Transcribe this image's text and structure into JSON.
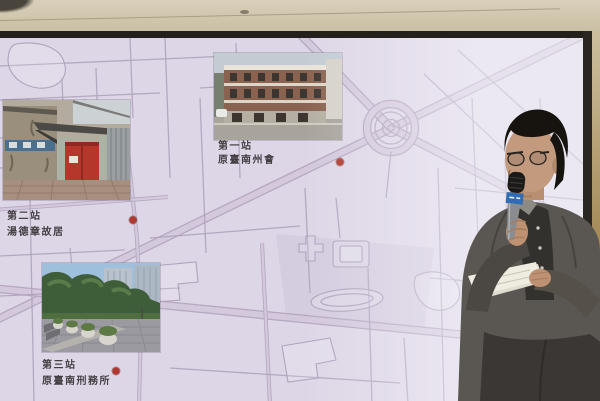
{
  "slide": {
    "stations": [
      {
        "station_label": "第一站",
        "place_name": "原臺南州會",
        "photo_alt": "historic-brick-building-photo",
        "marker": {
          "x": 340,
          "y": 124
        }
      },
      {
        "station_label": "第二站",
        "place_name": "湯德章故居",
        "photo_alt": "red-gate-alley-photo",
        "marker": {
          "x": 133,
          "y": 182
        }
      },
      {
        "station_label": "第三站",
        "place_name": "原臺南刑務所",
        "photo_alt": "tree-park-plaza-photo",
        "marker": {
          "x": 116,
          "y": 333
        }
      }
    ]
  },
  "colors": {
    "map-bg": "#ddd6e6",
    "road-edge": "#b4a7c0",
    "road-fill": "#d3c8dc",
    "road-thin": "#afa3bd",
    "map-shade": "#cfc5db",
    "marker": "#b0372c",
    "label-color": "#453f44",
    "ceiling-hi": "#d9d0bb",
    "ceiling-lo": "#c9bfa4",
    "wall-hi": "#cdbf9e",
    "wall-lo": "#a18753",
    "suit": "#5a5651",
    "shirt": "#33312e",
    "skin": "#c49a7e",
    "hair": "#17130f",
    "mic-band": "#2f6cb3",
    "paper": "#efece2"
  }
}
